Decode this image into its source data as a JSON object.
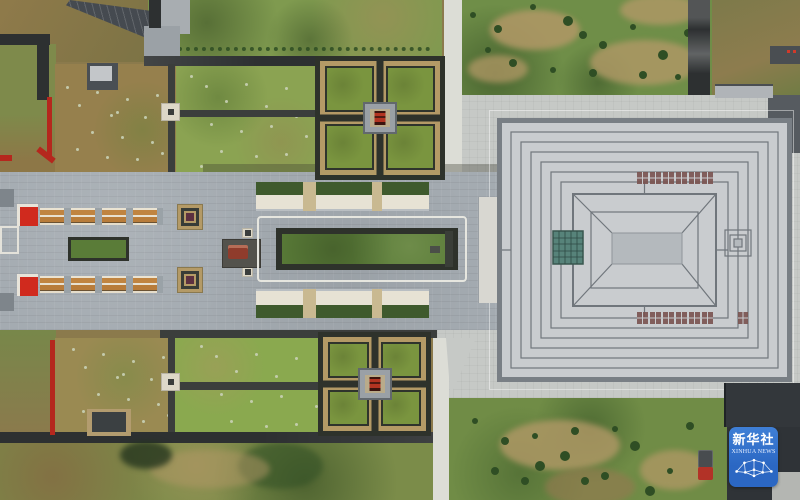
{
  "image": {
    "type": "aerial-drone-photograph",
    "scene_description": "Top-down aerial view of a symmetrical memorial / museum complex: a western ceremonial axis with red gates, orange-roofed colonnades, a sunken green lawn garden, a bronze-chariot display and two cross-shaped courtyard gardens with red central pavilions, leading east to a large square museum building with a concentric maze-patterned grey roof on a light stone plaza, surrounded by lawns, bare earth fields, tree rows, dark roads and white paths.",
    "width_px": 800,
    "height_px": 500
  },
  "watermark": {
    "chinese": "新华社",
    "english": "XINHUA NEWS",
    "icon": "globe-network-icon"
  },
  "palette": {
    "field-base": "#8b7a4c",
    "field-brown": "#96804d",
    "field-green": "#7f9a4f",
    "field-green-bright": "#8aa94f",
    "orchard-green": "#8ba352",
    "lawn-green": "#6f8e48",
    "lawn-green-2": "#708c46",
    "dirt-tan": "#b29868",
    "road-dark": "#2d3031",
    "path-dark": "#3b3e3c",
    "tree-dark": "#2f4e24",
    "sapling-pale": "#c9d1b6",
    "pavement": "#a4abb1",
    "pavement-dark": "#8d959c",
    "plaza": "#c6c9c6",
    "white-path": "#dcddd6",
    "node-white": "#ddd8c8",
    "red-wall": "#b5271d",
    "red-gate": "#d02a1e",
    "orange-roof": "#c08440",
    "cream": "#eae3d2",
    "garden-border": "#2e322b",
    "strip-green": "#5a7c38",
    "cross-tan": "#b49a66",
    "cross-green": "#7a953f",
    "platform-gray": "#9aa0a6",
    "platform-inner": "#b9ab8a",
    "pavilion-red": "#b23421",
    "teal": "#57837a",
    "skylight-red": "#7a5350",
    "roof-light": "#c9cccf",
    "roof-line": "#70767c",
    "roof-frame": "#797f85",
    "roof-mid": "#b4b9bd",
    "ramp": "#d8d7d1",
    "dark-roof": "#33373b",
    "badge-blue": "#2b67c3",
    "badge-blue-top": "#3f7fd6",
    "truck-red": "#b23227",
    "truck-body": "#484c4f"
  }
}
